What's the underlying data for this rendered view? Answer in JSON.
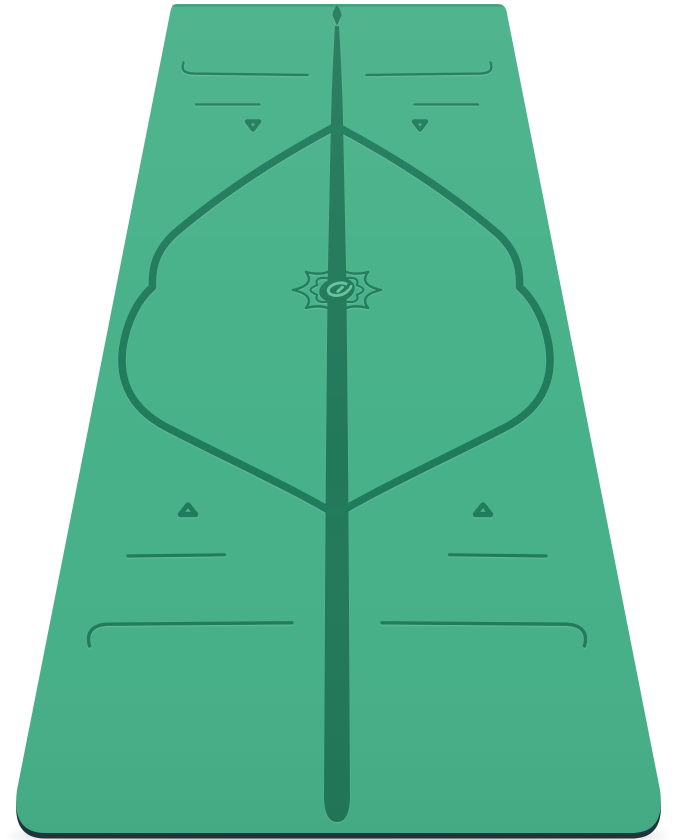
{
  "meta": {
    "type": "product-photo",
    "alt": "Green yoga mat standing upright on a white background, decorated with dark green alignment guide lines: a central spine line with an arrow tip, a curly-brace diamond outline, paired placement lines, hollow triangle markers and a lotus logo with an oval swirl at the centre"
  },
  "colors": {
    "background": "#ffffff",
    "mat_surface": "#47b189",
    "marking": "#1f7b5b",
    "center_stripe": "#22795a",
    "mat_edge_dark": "#20343c",
    "shadow": "#5a646a",
    "logo_accent": "#62c39c"
  },
  "elements": {
    "mat_label": "yoga mat",
    "marking_labels": [
      "center alignment line",
      "arrow tip",
      "alignment diamond outline",
      "top placement lines",
      "bottom placement lines",
      "hollow triangle markers",
      "lotus logo"
    ]
  }
}
